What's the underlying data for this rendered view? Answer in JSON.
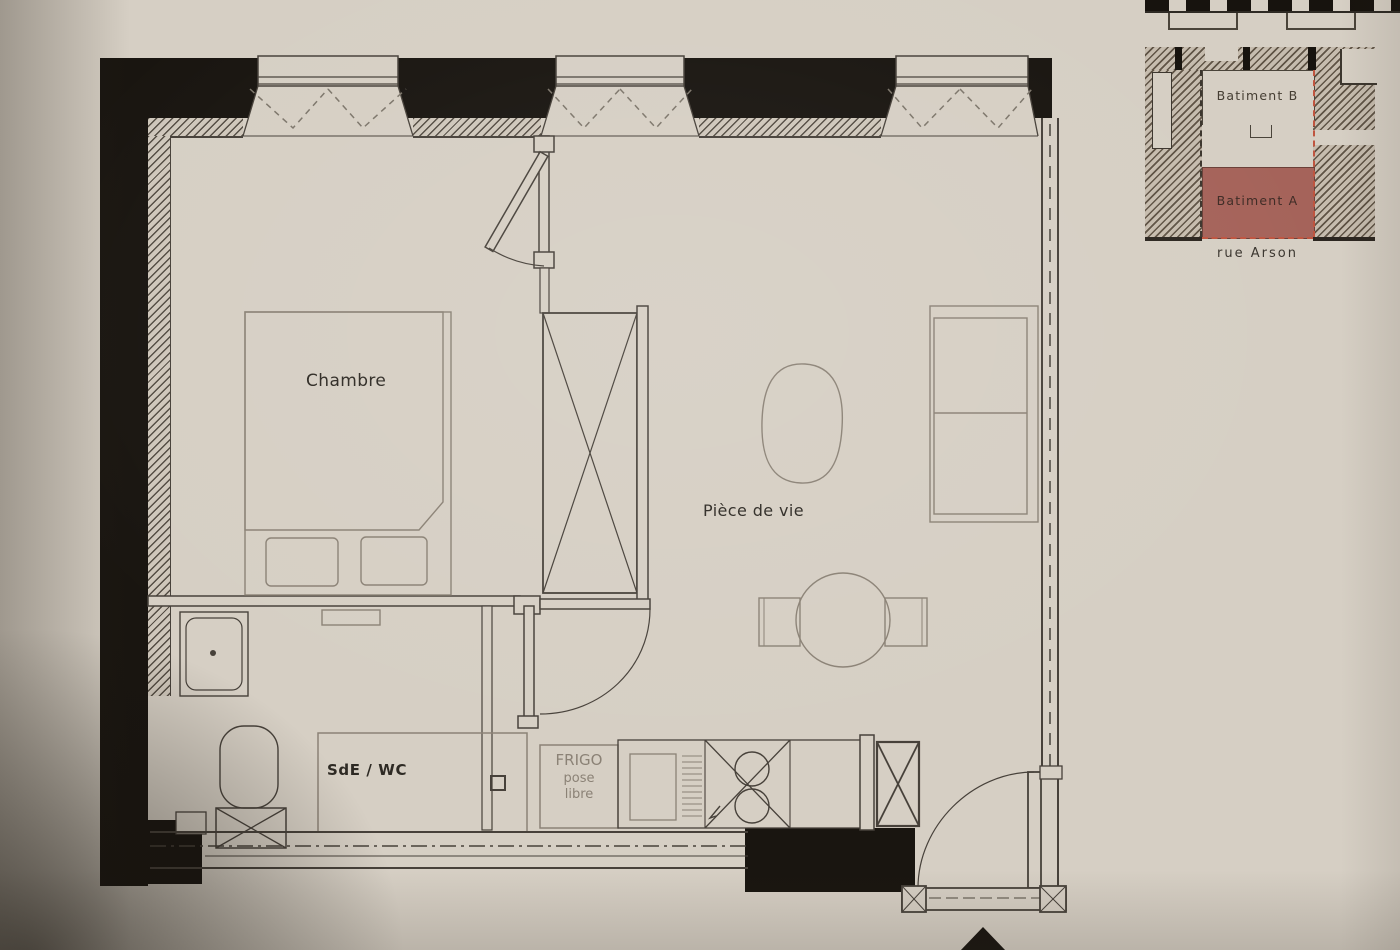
{
  "plan": {
    "room_labels": {
      "chambre": "Chambre",
      "piece_de_vie": "Pièce de vie",
      "sde_wc": "SdE / WC"
    },
    "annotations": {
      "frigo_line1": "FRIGO",
      "frigo_line2": "pose",
      "frigo_line3": "libre"
    }
  },
  "site_map": {
    "building_b_label": "Batiment B",
    "building_a_label": "Batiment A",
    "street_label": "rue Arson"
  },
  "symbols": {
    "entrance_arrow": "black triangle pointing up at apartment entrance",
    "window": "dashed double-V casement symbol in wall opening",
    "door": "leaf with quarter-circle swing arc",
    "wardrobe": "rectangle crossed by X diagonals",
    "column": "small square crossed by X diagonals",
    "sink": "double round bowls in crossed cabinet",
    "shower": "square tray with centre drain dot",
    "toilet": "rounded capsule shape"
  },
  "colors": {
    "paper": "#d6cfc4",
    "wall_black": "#191510",
    "ink": "#47413a",
    "furniture_gray": "#8b8276",
    "frigo_text": "#8b8276",
    "building_a_fill": "#a5635a",
    "parcel_dash_red": "#bf5540"
  }
}
